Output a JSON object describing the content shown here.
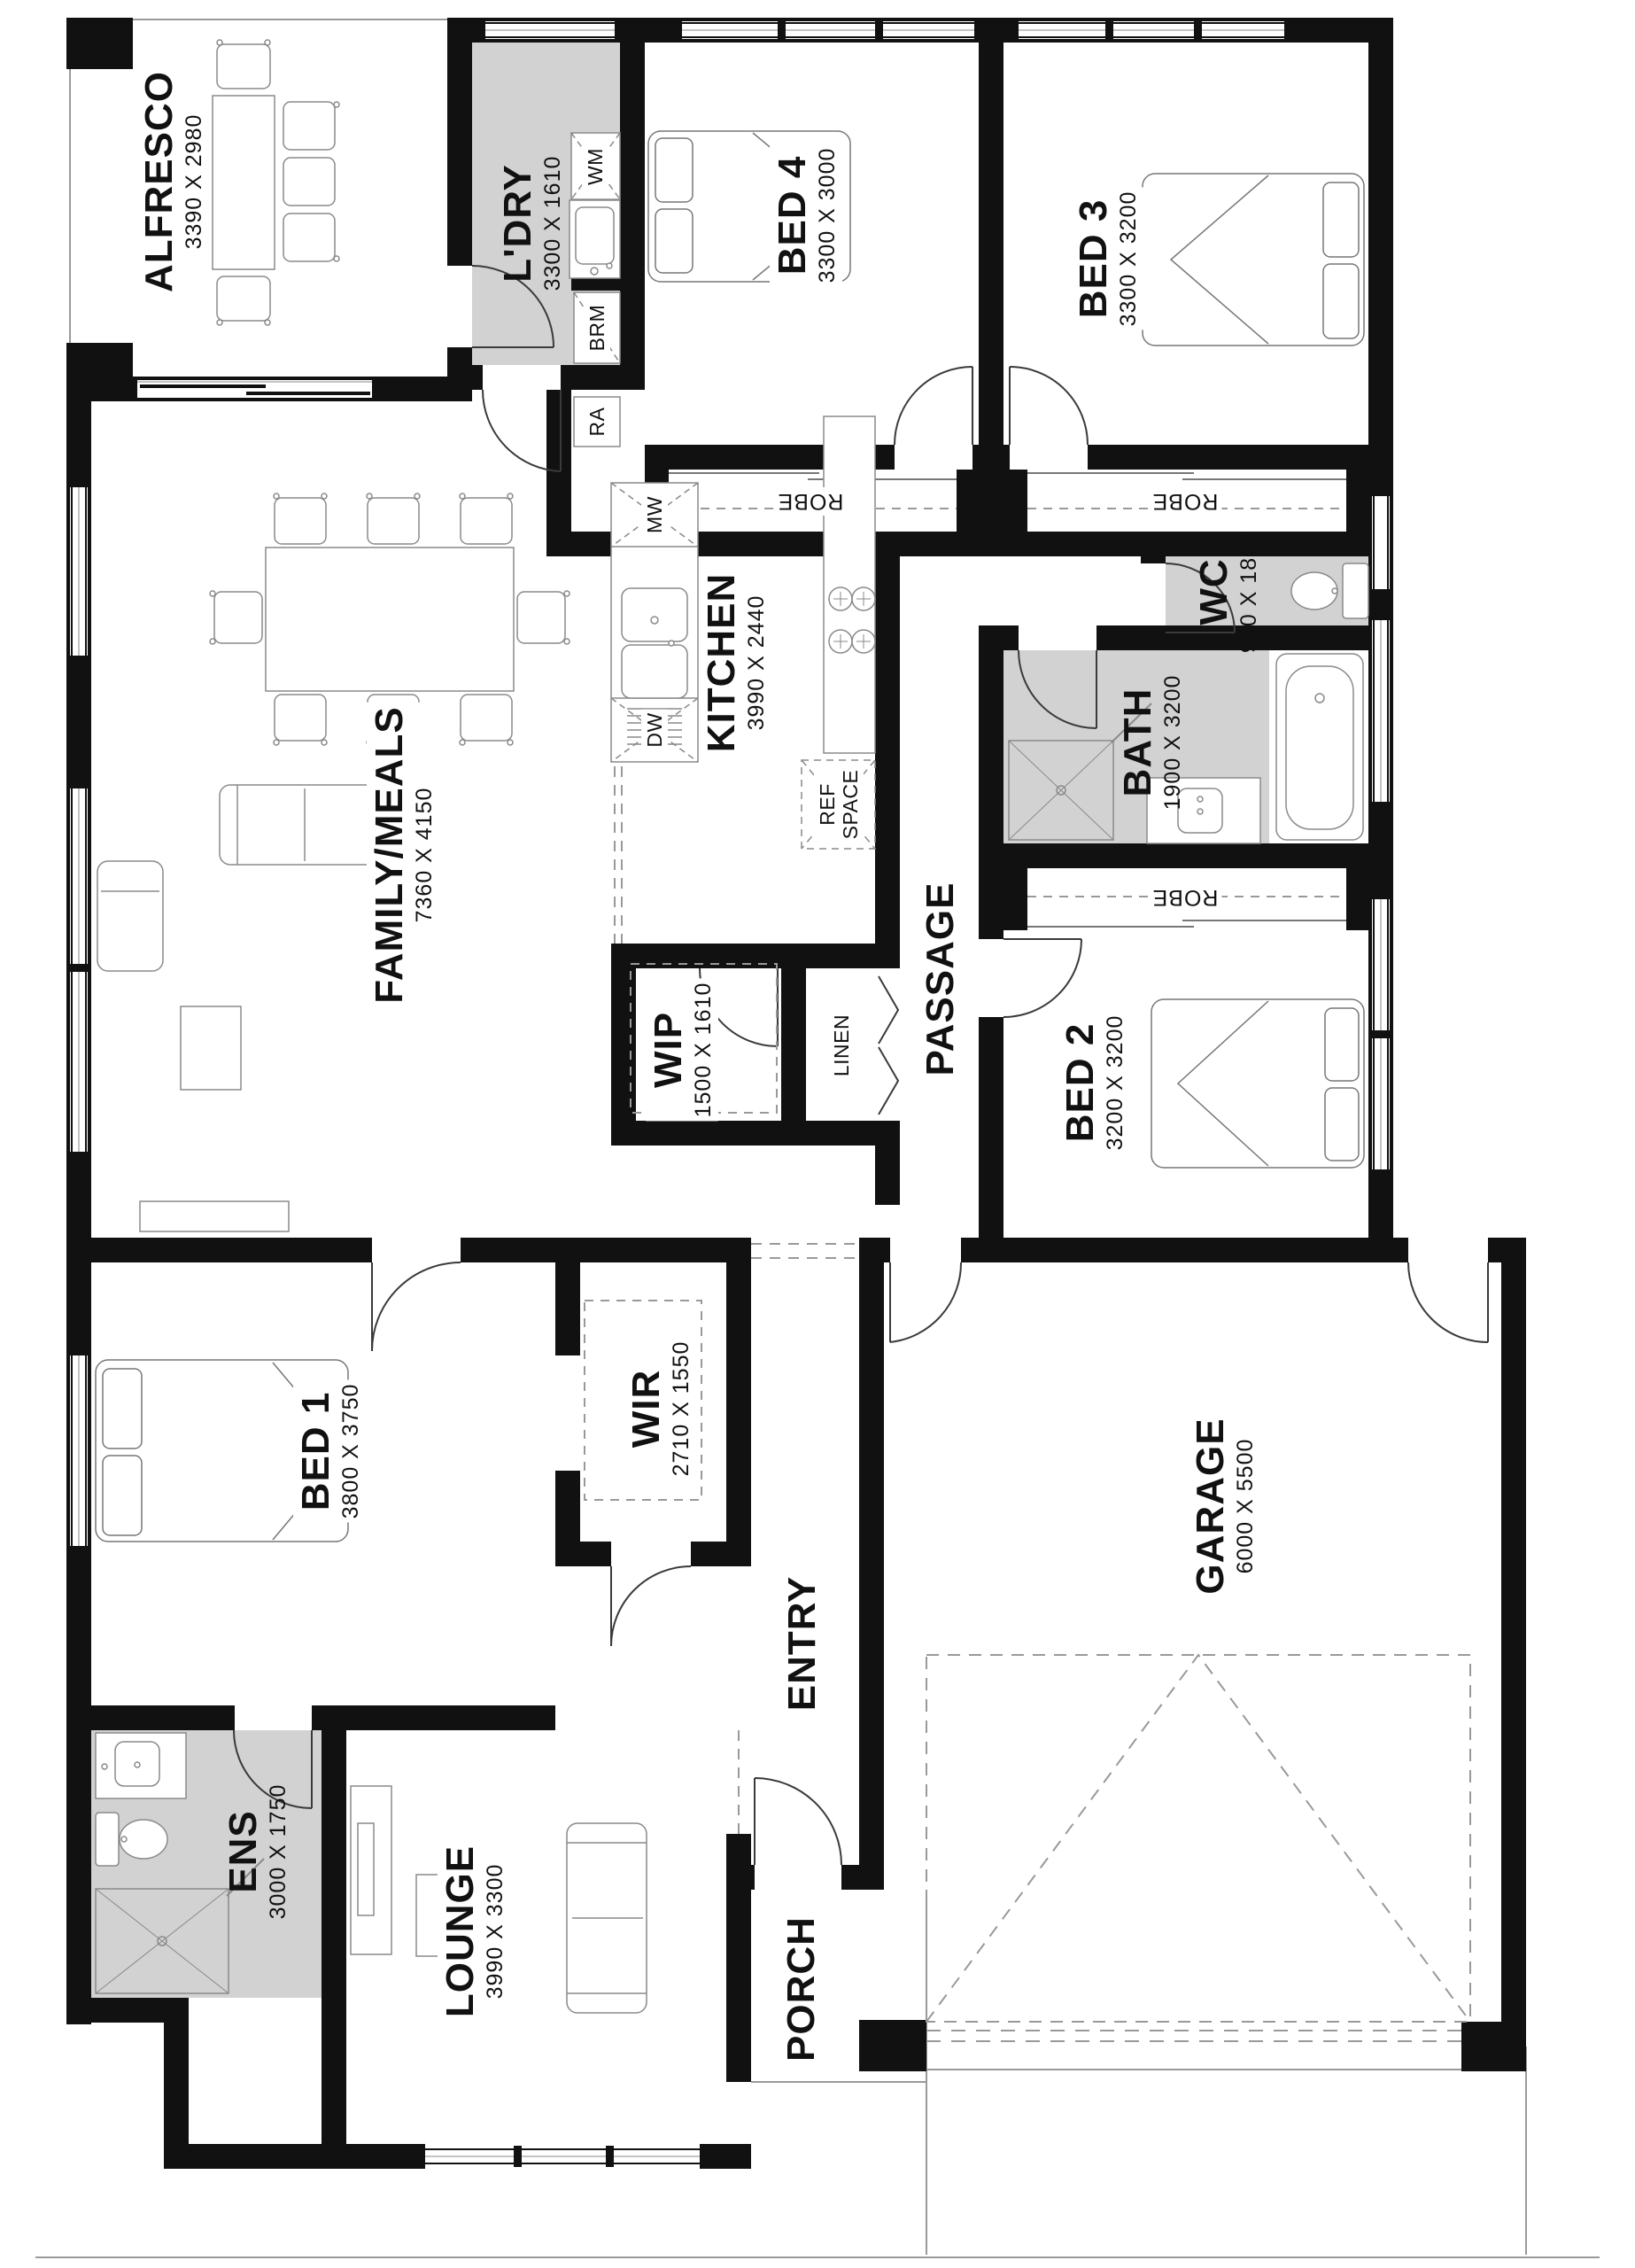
{
  "rooms": {
    "alfresco": {
      "name": "ALFRESCO",
      "dims": "3390 X 2980"
    },
    "laundry": {
      "name": "L'DRY",
      "dims": "3300 X 1610"
    },
    "bed4": {
      "name": "BED 4",
      "dims": "3300 X 3000"
    },
    "bed3": {
      "name": "BED 3",
      "dims": "3300 X 3200"
    },
    "wc": {
      "name": "WC",
      "dims": "900 X 1800"
    },
    "bath": {
      "name": "BATH",
      "dims": "1900 X 3200"
    },
    "bed2": {
      "name": "BED 2",
      "dims": "3200 X 3200"
    },
    "kitchen": {
      "name": "KITCHEN",
      "dims": "3990 X 2440"
    },
    "family": {
      "name": "FAMILY/MEALS",
      "dims": "7360 X 4150"
    },
    "wip": {
      "name": "WIP",
      "dims": "1500 X 1610"
    },
    "passage": {
      "name": "PASSAGE"
    },
    "linen": {
      "name": "LINEN"
    },
    "bed1": {
      "name": "BED 1",
      "dims": "3800 X 3750"
    },
    "wir": {
      "name": "WIR",
      "dims": "2710 X 1550"
    },
    "entry": {
      "name": "ENTRY"
    },
    "garage": {
      "name": "GARAGE",
      "dims": "6000 X 5500"
    },
    "ens": {
      "name": "ENS",
      "dims": "3000 X 1750"
    },
    "lounge": {
      "name": "LOUNGE",
      "dims": "3990 X 3300"
    },
    "porch": {
      "name": "PORCH"
    }
  },
  "fixtures": {
    "wm": "WM",
    "brm": "BRM",
    "ra": "RA",
    "mw": "MW",
    "dw": "DW",
    "ref_line1": "REF",
    "ref_line2": "SPACE",
    "robe": "ROBE"
  },
  "colors": {
    "wall": "#111111",
    "wet_area": "#d2d2d2",
    "line": "#8a8a8a"
  }
}
